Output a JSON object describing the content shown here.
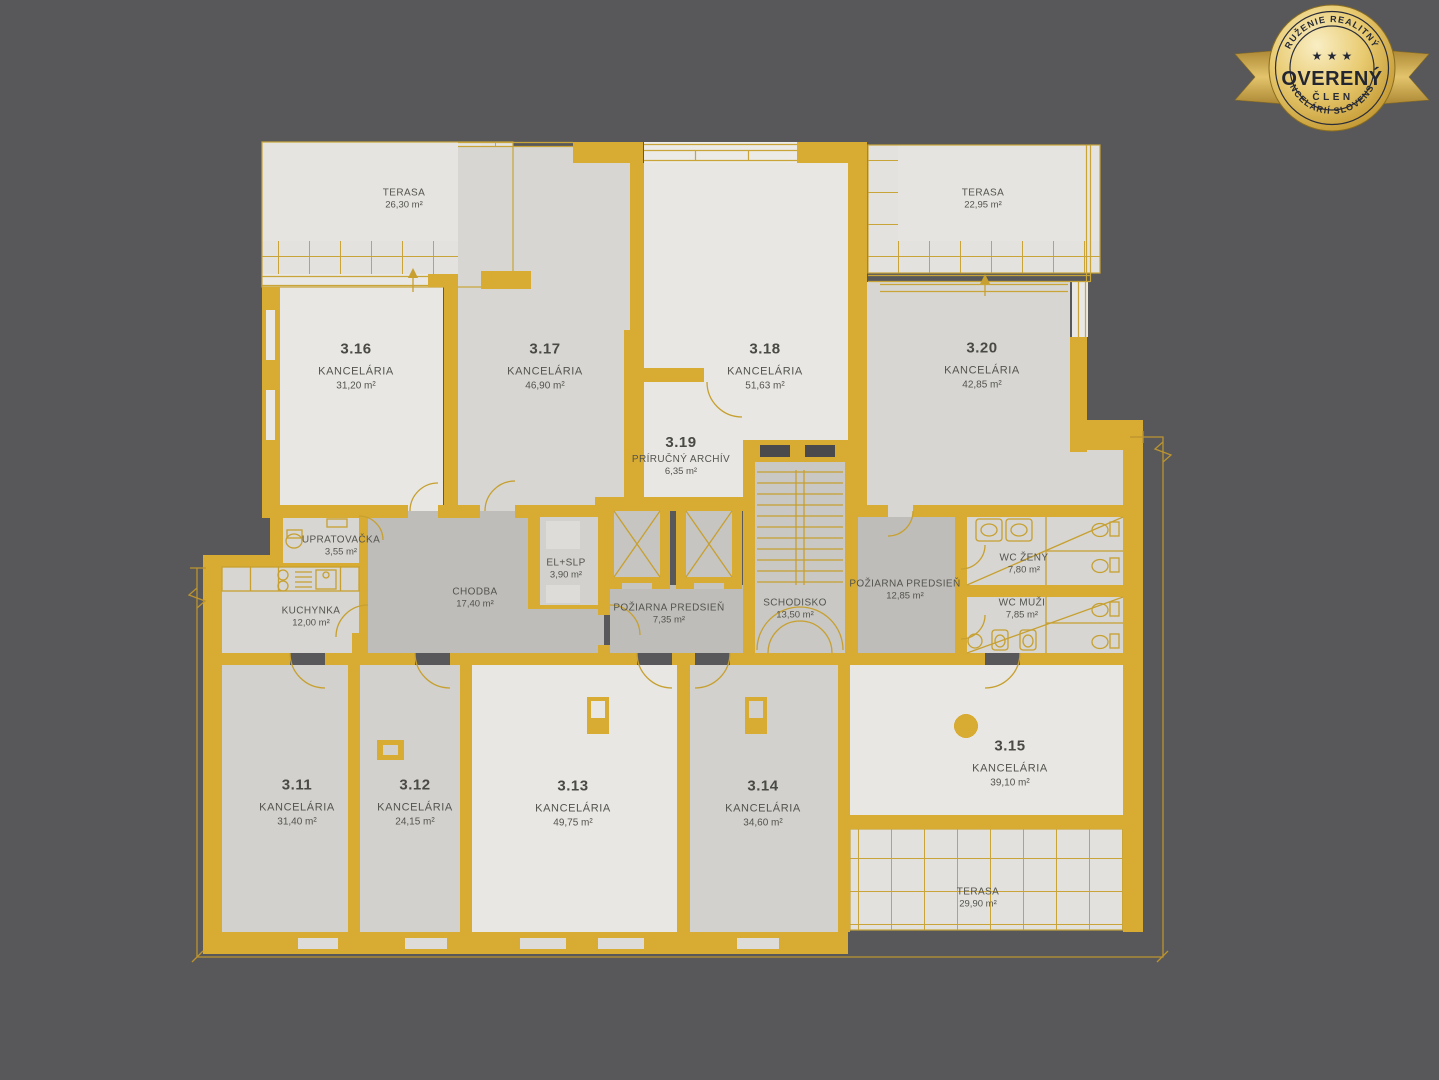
{
  "badge": {
    "arc_top": "ZDRUŽENIE REALITNÝCH",
    "arc_bottom": "KANCELÁRIÍ SLOVENSKA",
    "stars": "★ ★ ★",
    "title": "OVERENÝ",
    "subtitle": "ČLEN",
    "gold_color": "#d9b052",
    "text_color": "#262a36"
  },
  "plan": {
    "wall_color": "#d8ab33",
    "background_color": "#58585a",
    "rooms": [
      {
        "number": "",
        "type": "TERASA",
        "area": "26,30 m²"
      },
      {
        "number": "3.16",
        "type": "KANCELÁRIA",
        "area": "31,20 m²"
      },
      {
        "number": "3.17",
        "type": "KANCELÁRIA",
        "area": "46,90 m²"
      },
      {
        "number": "3.18",
        "type": "KANCELÁRIA",
        "area": "51,63 m²"
      },
      {
        "number": "3.19",
        "type": "PRÍRUČNÝ ARCHÍV",
        "area": "6,35 m²"
      },
      {
        "number": "",
        "type": "TERASA",
        "area": "22,95 m²"
      },
      {
        "number": "3.20",
        "type": "KANCELÁRIA",
        "area": "42,85 m²"
      },
      {
        "number": "",
        "type": "UPRATOVAČKA",
        "area": "3,55 m²"
      },
      {
        "number": "",
        "type": "KUCHYNKA",
        "area": "12,00 m²"
      },
      {
        "number": "",
        "type": "CHODBA",
        "area": "17,40 m²"
      },
      {
        "number": "",
        "type": "EL+SLP",
        "area": "3,90 m²"
      },
      {
        "number": "",
        "type": "POŽIARNA PREDSIEŇ",
        "area": "7,35 m²"
      },
      {
        "number": "",
        "type": "SCHODISKO",
        "area": "13,50 m²"
      },
      {
        "number": "",
        "type": "POŽIARNA PREDSIEŇ",
        "area": "12,85 m²"
      },
      {
        "number": "",
        "type": "WC ŽENY",
        "area": "7,80 m²"
      },
      {
        "number": "",
        "type": "WC MUŽI",
        "area": "7,85 m²"
      },
      {
        "number": "3.11",
        "type": "KANCELÁRIA",
        "area": "31,40 m²"
      },
      {
        "number": "3.12",
        "type": "KANCELÁRIA",
        "area": "24,15 m²"
      },
      {
        "number": "3.13",
        "type": "KANCELÁRIA",
        "area": "49,75 m²"
      },
      {
        "number": "3.14",
        "type": "KANCELÁRIA",
        "area": "34,60 m²"
      },
      {
        "number": "3.15",
        "type": "KANCELÁRIA",
        "area": "39,10 m²"
      },
      {
        "number": "",
        "type": "TERASA",
        "area": "29,90 m²"
      }
    ]
  }
}
